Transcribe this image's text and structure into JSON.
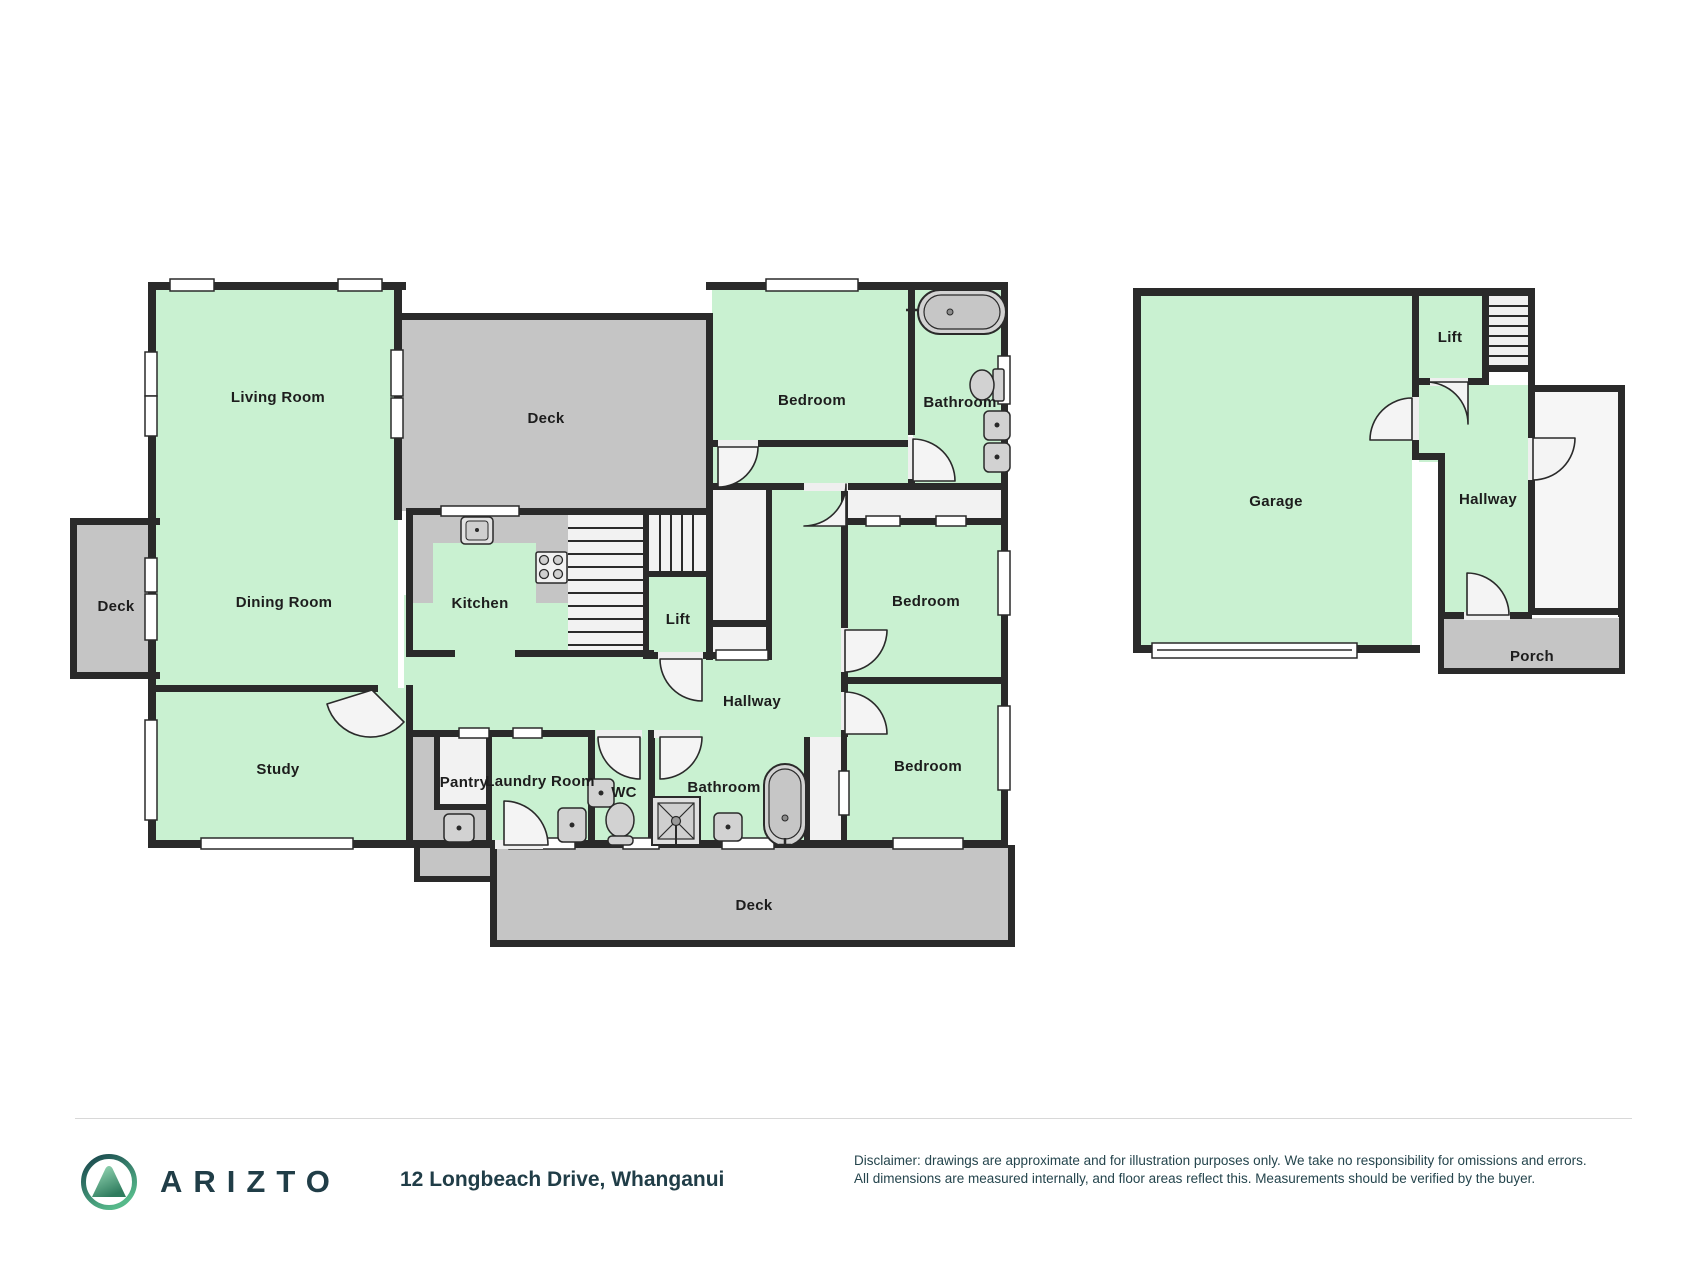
{
  "floor1": {
    "rooms": {
      "living_room": "Living Room",
      "dining_room": "Dining Room",
      "study": "Study",
      "kitchen": "Kitchen",
      "deck_top": "Deck",
      "deck_left": "Deck",
      "deck_bottom": "Deck",
      "lift": "Lift",
      "hallway": "Hallway",
      "pantry": "Pantry",
      "laundry_room": "Laundry Room",
      "wc": "WC",
      "bathroom_front": "Bathroom",
      "bathroom_rear": "Bathroom",
      "bedroom_front": "Bedroom",
      "bedroom_middle": "Bedroom",
      "bedroom_rear": "Bedroom"
    }
  },
  "floor2": {
    "rooms": {
      "garage": "Garage",
      "lift": "Lift",
      "hallway": "Hallway",
      "porch": "Porch"
    }
  },
  "icons": {
    "bathtub": "bathtub-icon",
    "toilet": "toilet-icon",
    "sink": "sink-icon",
    "shower": "shower-icon",
    "stove": "stove-icon",
    "stairs": "stairs-icon",
    "door": "door-arc-icon",
    "window": "window-icon",
    "logo": "arizto-mountain-logo"
  },
  "colors": {
    "room_fill": "#c9f1d1",
    "deck_fill": "#c5c5c5",
    "wall": "#2a2a2a",
    "white_area": "#f4f4f4",
    "fixture_fill": "#d2d2d2",
    "brand_dark": "#203d47",
    "logo_green_dark": "#2f7c5e",
    "logo_green_light": "#9fe0bd"
  },
  "footer": {
    "brand": "ARIZTO",
    "address": "12 Longbeach Drive, Whanganui",
    "disclaimer_line1": "Disclaimer: drawings are approximate and for illustration purposes only. We take no responsibility for omissions and errors.",
    "disclaimer_line2": "All dimensions are measured internally, and floor areas reflect this. Measurements should be verified by the buyer."
  }
}
